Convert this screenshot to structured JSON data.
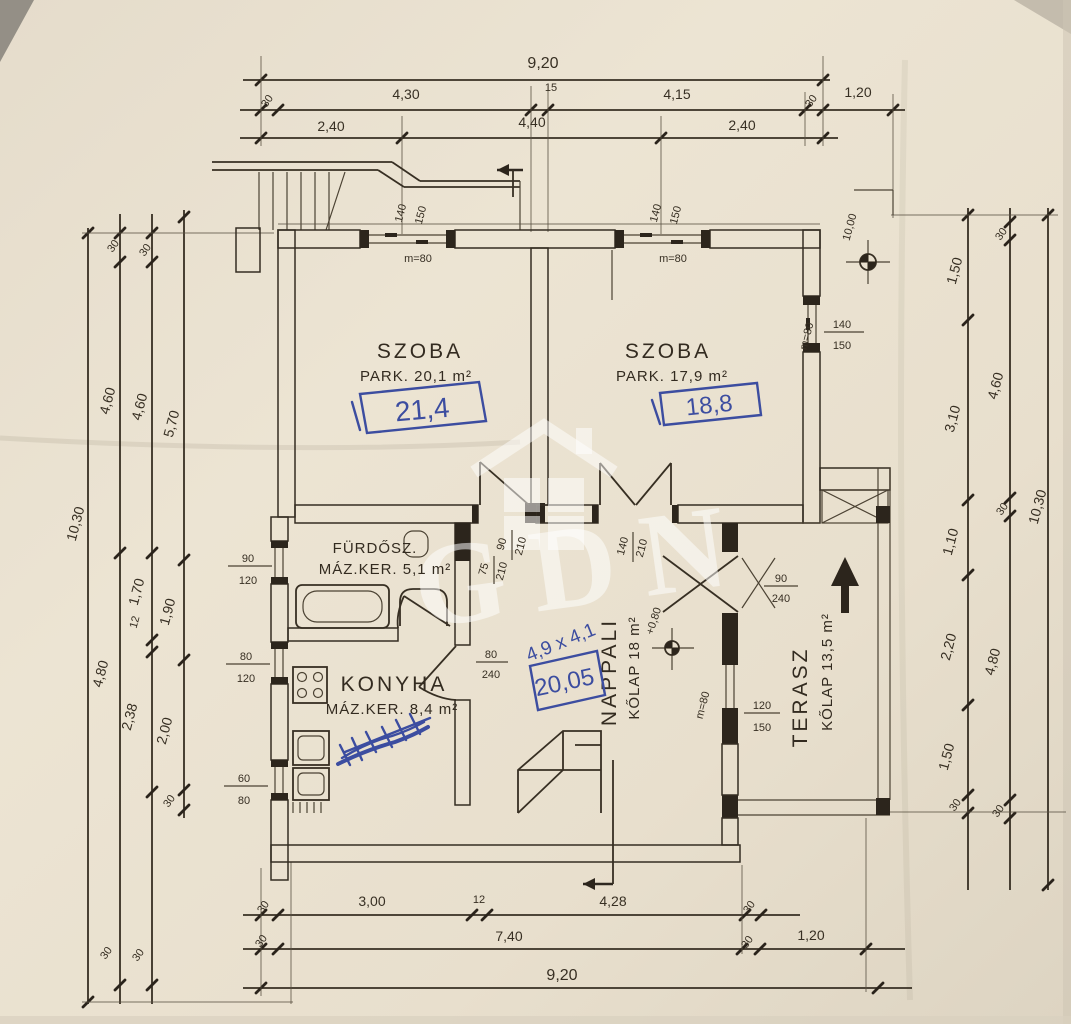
{
  "document": {
    "type": "scanned hand-drawn floor plan",
    "paper_color": "#e9e1d0",
    "ink_color": "#372f24",
    "pen_color": "#3c4da0"
  },
  "watermark": {
    "text": "GDN"
  },
  "rooms": {
    "szoba_left": {
      "name": "SZOBA",
      "floor": "PARK. 20,1 m²",
      "pen_note": "21,4"
    },
    "szoba_right": {
      "name": "SZOBA",
      "floor": "PARK. 17,9 m²",
      "pen_note": "18,8"
    },
    "furdoszoba": {
      "name": "FÜRDŐSZ.",
      "floor": "MÁZ.KER. 5,1 m²"
    },
    "konyha": {
      "name": "KONYHA",
      "floor": "MÁZ.KER. 8,4 m²"
    },
    "nappali": {
      "name": "NAPPALI",
      "floor": "KŐLAP 18 m²",
      "pen_size": "4,9 x 4,1",
      "pen_area": "20,05",
      "level": "+0,80"
    },
    "terasz": {
      "name": "TERASZ",
      "floor": "KŐLAP 13,5 m²"
    }
  },
  "levels": {
    "site_benchmark": "10,00"
  },
  "dims": {
    "top": {
      "total": "9,20",
      "row2": [
        "30",
        "4,30",
        "15",
        "4,15",
        "30",
        "1,20"
      ],
      "row3": [
        "2,40",
        "4,40",
        "2,40"
      ]
    },
    "bottom": {
      "row1": [
        "30",
        "3,00",
        "12",
        "4,28",
        "30"
      ],
      "row2": [
        "30",
        "7,40",
        "30",
        "1,20"
      ],
      "total": "9,20"
    },
    "left": {
      "outer": "10,30",
      "chain2": [
        "30",
        "4,60",
        "4,80",
        "30"
      ],
      "chain3": [
        "30",
        "4,60",
        "1,70",
        "12",
        "2,38",
        "30"
      ],
      "chain4": [
        "5,70",
        "1,90",
        "2,00",
        "30"
      ]
    },
    "right": {
      "inner": [
        "1,50",
        "3,10",
        "1,10",
        "2,20",
        "1,50",
        "30"
      ],
      "middle": [
        "30",
        "4,60",
        "30",
        "4,80",
        "30"
      ],
      "outer": "10,30"
    }
  },
  "openings": {
    "window_top_left": {
      "w": "140",
      "h": "150",
      "parapet": "m=80"
    },
    "window_top_right": {
      "w": "140",
      "h": "150",
      "parapet": "m=80"
    },
    "window_right": {
      "w": "140",
      "h": "150",
      "parapet": "m=80"
    },
    "window_bath": {
      "w": "90",
      "h": "120"
    },
    "window_kitchen": {
      "w": "80",
      "h": "120"
    },
    "window_kitchen_small": {
      "w": "60",
      "h": "80"
    },
    "door_szoba_left": {
      "w": "90",
      "h": "210"
    },
    "door_szoba_right": {
      "w": "140",
      "h": "210"
    },
    "door_bath": {
      "w": "75",
      "h": "210"
    },
    "door_kitchen": {
      "w": "80",
      "h": "240"
    },
    "door_terasz": {
      "w": "90",
      "h": "240"
    },
    "window_terasz": {
      "w": "120",
      "h": "150",
      "parapet": "m=80"
    }
  }
}
